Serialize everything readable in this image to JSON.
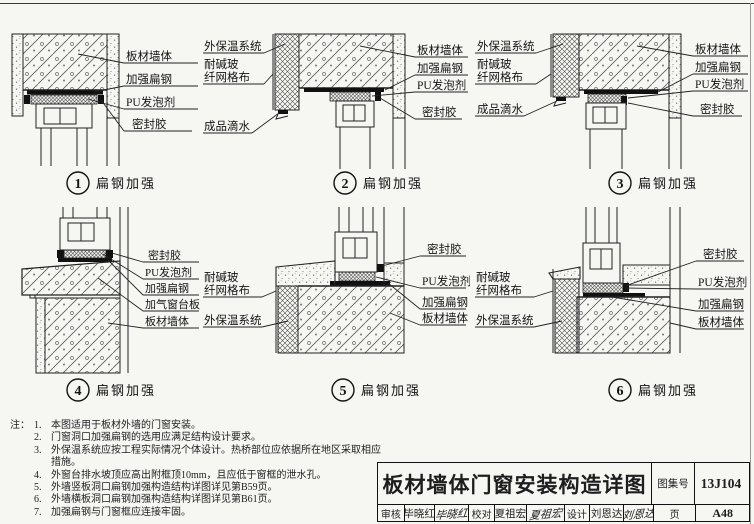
{
  "colors": {
    "paper": "#f6f6f3",
    "ink": "#1e1e1e"
  },
  "details": [
    {
      "num": "1",
      "caption": "扁钢加强",
      "right_labels": [
        "板材墙体",
        "加强扁钢",
        "PU发泡剂",
        "密封胶"
      ]
    },
    {
      "num": "2",
      "caption": "扁钢加强",
      "left_labels": [
        "外保温系统",
        "耐碱玻",
        "纤网格布",
        "成品滴水"
      ],
      "right_labels": [
        "板材墙体",
        "加强扁钢",
        "PU发泡剂",
        "密封胶"
      ]
    },
    {
      "num": "3",
      "caption": "扁钢加强",
      "left_labels": [
        "外保温系统",
        "耐碱玻",
        "纤网格布",
        "成品滴水"
      ],
      "right_labels": [
        "板材墙体",
        "加强扁钢",
        "PU发泡剂",
        "密封胶"
      ]
    },
    {
      "num": "4",
      "caption": "扁钢加强",
      "right_labels": [
        "密封胶",
        "PU发泡剂",
        "加强扁钢",
        "加气窗台板",
        "板材墙体"
      ]
    },
    {
      "num": "5",
      "caption": "扁钢加强",
      "left_labels": [
        "耐碱玻",
        "纤网格布",
        "外保温系统"
      ],
      "right_labels": [
        "密封胶",
        "PU发泡剂",
        "加强扁钢",
        "板材墙体"
      ]
    },
    {
      "num": "6",
      "caption": "扁钢加强",
      "left_labels": [
        "耐碱玻",
        "纤网格布",
        "外保温系统"
      ],
      "right_labels": [
        "密封胶",
        "PU发泡剂",
        "加强扁钢",
        "板材墙体"
      ]
    }
  ],
  "notes": {
    "prefix": "注：",
    "items": [
      {
        "n": "1.",
        "t": "本图适用于板材外墙的门窗安装。"
      },
      {
        "n": "2.",
        "t": "门窗洞口加强扁钢的选用应满足结构设计要求。"
      },
      {
        "n": "3.",
        "t": "外保温系统应按工程实际情况个体设计。热桥部位应依据所在地区采取相应措施。"
      },
      {
        "n": "4.",
        "t": "外窗台排水坡顶应高出附框顶10mm，且应低于窗框的泄水孔。"
      },
      {
        "n": "5.",
        "t": "外墙竖板洞口扁钢加强构造结构详图详见第B59页。"
      },
      {
        "n": "6.",
        "t": "外墙横板洞口扁钢加强构造结构详图详见第B61页。"
      },
      {
        "n": "7.",
        "t": "加强扁钢与门窗框应连接牢固。"
      }
    ]
  },
  "title_block": {
    "title": "板材墙体门窗安装构造详图",
    "atlas_label": "图集号",
    "atlas_no": "13J104",
    "page_label": "页",
    "page_no": "A48",
    "review_label": "审核",
    "reviewer": "毕晓红",
    "reviewer_sig": "毕晓红",
    "check_label": "校对",
    "checker": "夏祖宏",
    "checker_sig": "夏祖宏",
    "design_label": "设计",
    "designer": "刘恩达",
    "designer_sig": "刘恩达"
  }
}
